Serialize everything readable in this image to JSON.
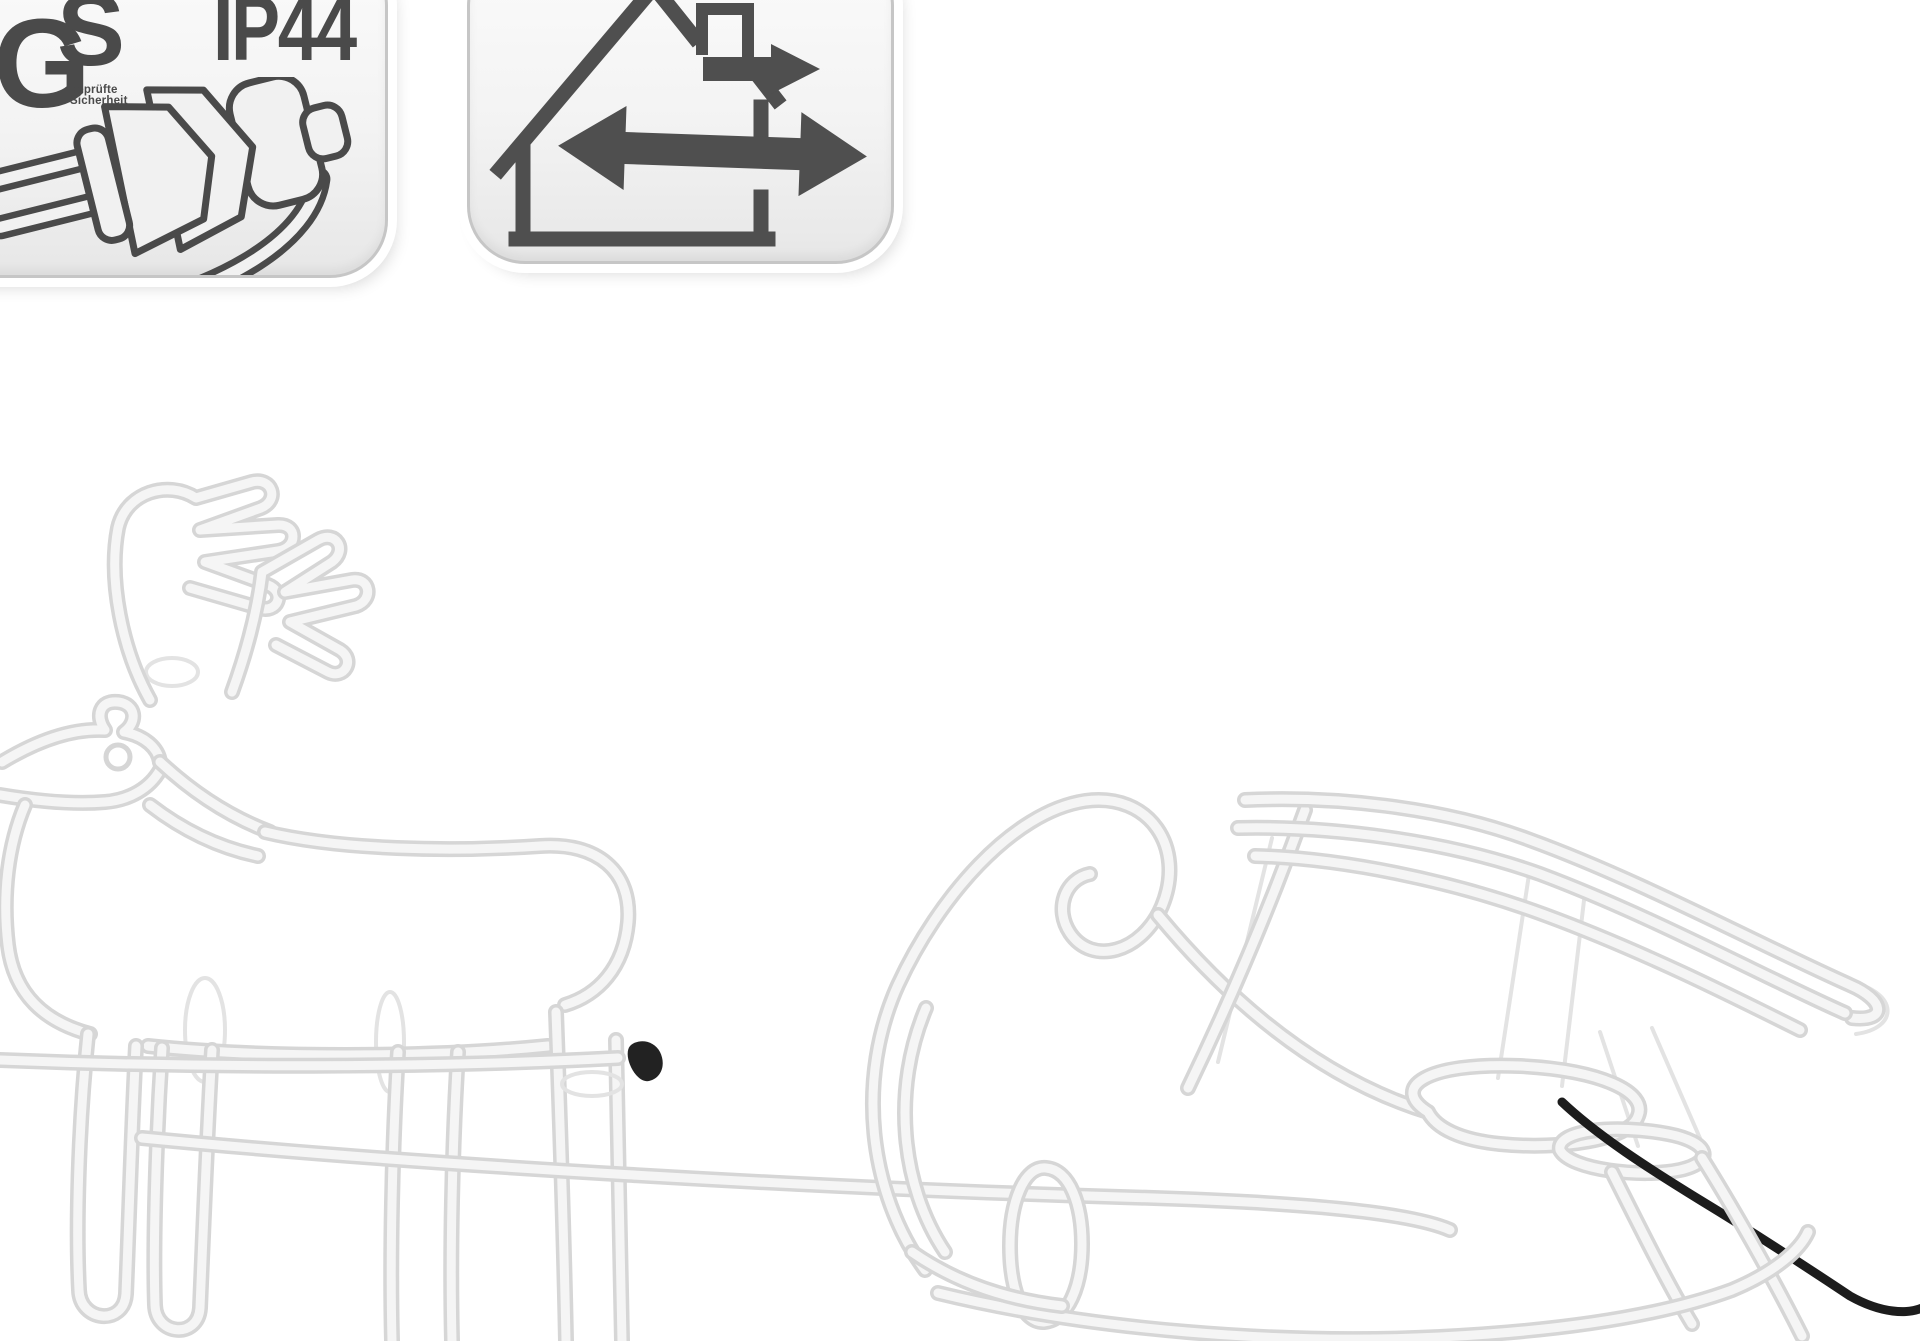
{
  "badges": {
    "safety": {
      "gs_mark": {
        "letter_g": "G",
        "letter_s": "S",
        "subtext_line1": "geprüfte",
        "subtext_line2": "Sicherheit"
      },
      "ip_rating": "IP44",
      "icon": "europlug-icon"
    },
    "usage": {
      "icon": "house-indoor-outdoor-icon",
      "meaning_icons": [
        "house-icon",
        "chimney-icon",
        "double-arrow-icon"
      ]
    }
  },
  "scene": {
    "subject": "reindeer-with-sleigh-rope-light-figure",
    "elements": [
      "reindeer-figure",
      "antlers",
      "sleigh-figure",
      "tow-rope",
      "power-cable",
      "cable-connector"
    ]
  },
  "colors": {
    "icon_gray": "#4a4a4a",
    "icon_gray2": "#4f4f4f",
    "badge_border": "#c6c6c6",
    "badge_fill": "#f1f1f1",
    "tube_o": "#d6d6d6",
    "tube_i": "#f5f5f5",
    "wire": "#e3e3e3",
    "cable": "#1c1c1c",
    "connector": "#222222",
    "background": "#ffffff"
  }
}
